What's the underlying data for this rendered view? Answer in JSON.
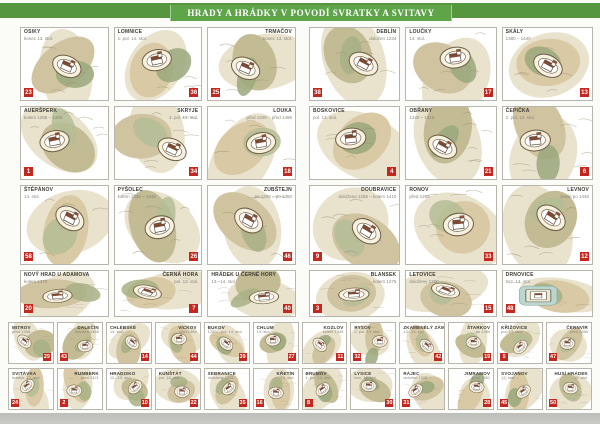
{
  "title": "HRADY A HRÁDKY V POVODÍ SVRATKY A SVITAVY",
  "colors": {
    "banner_green": "#55963f",
    "banner_center_green": "#5ea449",
    "badge_red": "#c4271d",
    "paper": "#fbfbf8"
  },
  "main_left": [
    {
      "name": "OSIKY",
      "subtitle": "konec 13. stol.",
      "badge": "23",
      "label_side": "left",
      "badge_corner": "bl"
    },
    {
      "name": "LOMNICE",
      "subtitle": "1. pol. 14. stol.",
      "badge": "36",
      "label_side": "left",
      "badge_corner": "br"
    },
    {
      "name": "TRMAČOV",
      "subtitle": "konec 13. stol.",
      "badge": "25",
      "label_side": "right",
      "badge_corner": "bl"
    },
    {
      "name": "AUERŠPERK",
      "subtitle": "kolem 1285 – 1490",
      "badge": "1",
      "label_side": "left",
      "badge_corner": "bl"
    },
    {
      "name": "SKRYJE",
      "subtitle": "2. pol. 14. stol.",
      "badge": "34",
      "label_side": "right",
      "badge_corner": "br"
    },
    {
      "name": "LOUKA",
      "subtitle": "před 1349 – před 1496",
      "badge": "18",
      "label_side": "right",
      "badge_corner": "br"
    },
    {
      "name": "ŠTĚPÁNOV",
      "subtitle": "14. stol.",
      "badge": "58",
      "label_side": "left",
      "badge_corner": "bl"
    },
    {
      "name": "PYŠOLEC",
      "subtitle": "kolem 1330 – 1446",
      "badge": "26",
      "label_side": "left",
      "badge_corner": "br"
    },
    {
      "name": "ZUBŠTEJN",
      "subtitle": "po 1208 – po 1350",
      "badge": "46",
      "label_side": "right",
      "badge_corner": "br"
    },
    {
      "name": "NOVÝ HRAD U ADAMOVA",
      "subtitle": "kolem 1470",
      "badge": "20",
      "label_side": "left",
      "badge_corner": "bl"
    },
    {
      "name": "ČERNÁ HORA",
      "subtitle": "pol. 13. stol.",
      "badge": "7",
      "label_side": "right",
      "badge_corner": "br"
    },
    {
      "name": "HRÁDEK U ČERNÉ HORY",
      "subtitle": "13.–14. stol.",
      "badge": "40",
      "label_side": "left",
      "badge_corner": "br"
    }
  ],
  "main_right": [
    {
      "name": "DEBLÍN",
      "subtitle": "doložen 1234",
      "badge": "38",
      "label_side": "right",
      "badge_corner": "bl"
    },
    {
      "name": "LOUČKY",
      "subtitle": "14. stol.",
      "badge": "17",
      "label_side": "left",
      "badge_corner": "br"
    },
    {
      "name": "SKÁLY",
      "subtitle": "1380 – 1440",
      "badge": "13",
      "label_side": "left",
      "badge_corner": "br"
    },
    {
      "name": "BOSKOVICE",
      "subtitle": "pol. 13. stol.",
      "badge": "4",
      "label_side": "left",
      "badge_corner": "br"
    },
    {
      "name": "OBŘANY",
      "subtitle": "1240 – 1316",
      "badge": "21",
      "label_side": "left",
      "badge_corner": "br"
    },
    {
      "name": "ČEPIČKA",
      "subtitle": "2. pol. 13. stol.",
      "badge": "6",
      "label_side": "left",
      "badge_corner": "br"
    },
    {
      "name": "DOUBRAVICE",
      "subtitle": "doložena 1255 – kolem 1410",
      "badge": "9",
      "label_side": "right",
      "badge_corner": "bl"
    },
    {
      "name": "RONOV",
      "subtitle": "před 1285",
      "badge": "33",
      "label_side": "left",
      "badge_corner": "br"
    },
    {
      "name": "LEVNOV",
      "subtitle": "zanikl po 1446",
      "badge": "12",
      "label_side": "right",
      "badge_corner": "br"
    },
    {
      "name": "BLANSEK",
      "subtitle": "kolem 1275",
      "badge": "3",
      "label_side": "right",
      "badge_corner": "bl"
    },
    {
      "name": "LETOVICE",
      "subtitle": "doloženy 1250",
      "badge": "15",
      "label_side": "left",
      "badge_corner": "br"
    },
    {
      "name": "DRNOVICE",
      "subtitle": "tvrz, 14. stol.",
      "badge": "48",
      "label_side": "left",
      "badge_corner": "bl",
      "moat": true
    }
  ],
  "bottom_rows": [
    [
      {
        "name": "MITROV",
        "subtitle": "před 1358",
        "badge": "29",
        "label_side": "left",
        "badge_corner": "br"
      },
      {
        "name": "DALEČÍN",
        "subtitle": "doložen 1358",
        "badge": "43",
        "label_side": "right",
        "badge_corner": "bl"
      },
      {
        "name": "CHLÉBSKÉ",
        "subtitle": "14. stol.",
        "badge": "14",
        "label_side": "left",
        "badge_corner": "br"
      },
      {
        "name": "VÍCKOV",
        "subtitle": "před 1364",
        "badge": "44",
        "label_side": "right",
        "badge_corner": "br"
      },
      {
        "name": "BUKOV",
        "subtitle": "1285 – pol. 14. stol.",
        "badge": "39",
        "label_side": "left",
        "badge_corner": "br"
      },
      {
        "name": "CHLUM",
        "subtitle": "13. stol.",
        "badge": "27",
        "label_side": "left",
        "badge_corner": "br"
      },
      {
        "name": "KOZLOV",
        "subtitle": "kolem 1349",
        "badge": "11",
        "label_side": "right",
        "badge_corner": "br"
      },
      {
        "name": "RYSOV",
        "subtitle": "2. pol. 13. stol.",
        "badge": "32",
        "label_side": "left",
        "badge_corner": "bl"
      },
      {
        "name": "ZKAMENĚLÝ ZÁMEK",
        "subtitle": "13.–14. stol.",
        "badge": "42",
        "label_side": "left",
        "badge_corner": "br"
      },
      {
        "name": "ŠTARKOV",
        "subtitle": "po 1380",
        "badge": "19",
        "label_side": "right",
        "badge_corner": "br"
      },
      {
        "name": "KŘÍŽOVICE",
        "subtitle": "pol. 13. stol.",
        "badge": "5",
        "label_side": "left",
        "badge_corner": "bl"
      },
      {
        "name": "ČERNVÍR",
        "subtitle": "před 1285",
        "badge": "47",
        "label_side": "right",
        "badge_corner": "bl"
      }
    ],
    [
      {
        "name": "SVITÁVKA",
        "subtitle": "hrádek, 13. stol.",
        "badge": "24",
        "label_side": "left",
        "badge_corner": "bl"
      },
      {
        "name": "RUMBERK",
        "subtitle": "před 1321",
        "badge": "2",
        "label_side": "right",
        "badge_corner": "bl"
      },
      {
        "name": "HRADISKO",
        "subtitle": "12.–13. stol.",
        "badge": "10",
        "label_side": "left",
        "badge_corner": "br"
      },
      {
        "name": "KUNŠTÁT",
        "subtitle": "pol. 13. stol.",
        "badge": "22",
        "label_side": "left",
        "badge_corner": "br"
      },
      {
        "name": "SEBRANICE",
        "subtitle": "doloženy 1281",
        "badge": "35",
        "label_side": "left",
        "badge_corner": "br"
      },
      {
        "name": "KŘETÍN",
        "subtitle": "14. stol.",
        "badge": "16",
        "label_side": "right",
        "badge_corner": "bl"
      },
      {
        "name": "BRUMOV",
        "subtitle": "1. pol. 14. stol.",
        "badge": "8",
        "label_side": "left",
        "badge_corner": "bl"
      },
      {
        "name": "LYSICE",
        "subtitle": "tvrz, 14. stol.",
        "badge": "30",
        "label_side": "left",
        "badge_corner": "br"
      },
      {
        "name": "RÁJEC",
        "subtitle": "doložen 1325",
        "badge": "31",
        "label_side": "left",
        "badge_corner": "bl"
      },
      {
        "name": "JIMRAMOV",
        "subtitle": "před 1361",
        "badge": "28",
        "label_side": "right",
        "badge_corner": "br"
      },
      {
        "name": "SVOJANOV",
        "subtitle": "13. stol.",
        "badge": "45",
        "label_side": "left",
        "badge_corner": "bl"
      },
      {
        "name": "HUSÍ HRÁDEK",
        "subtitle": "15. stol.",
        "badge": "50",
        "label_side": "right",
        "badge_corner": "bl"
      }
    ]
  ]
}
